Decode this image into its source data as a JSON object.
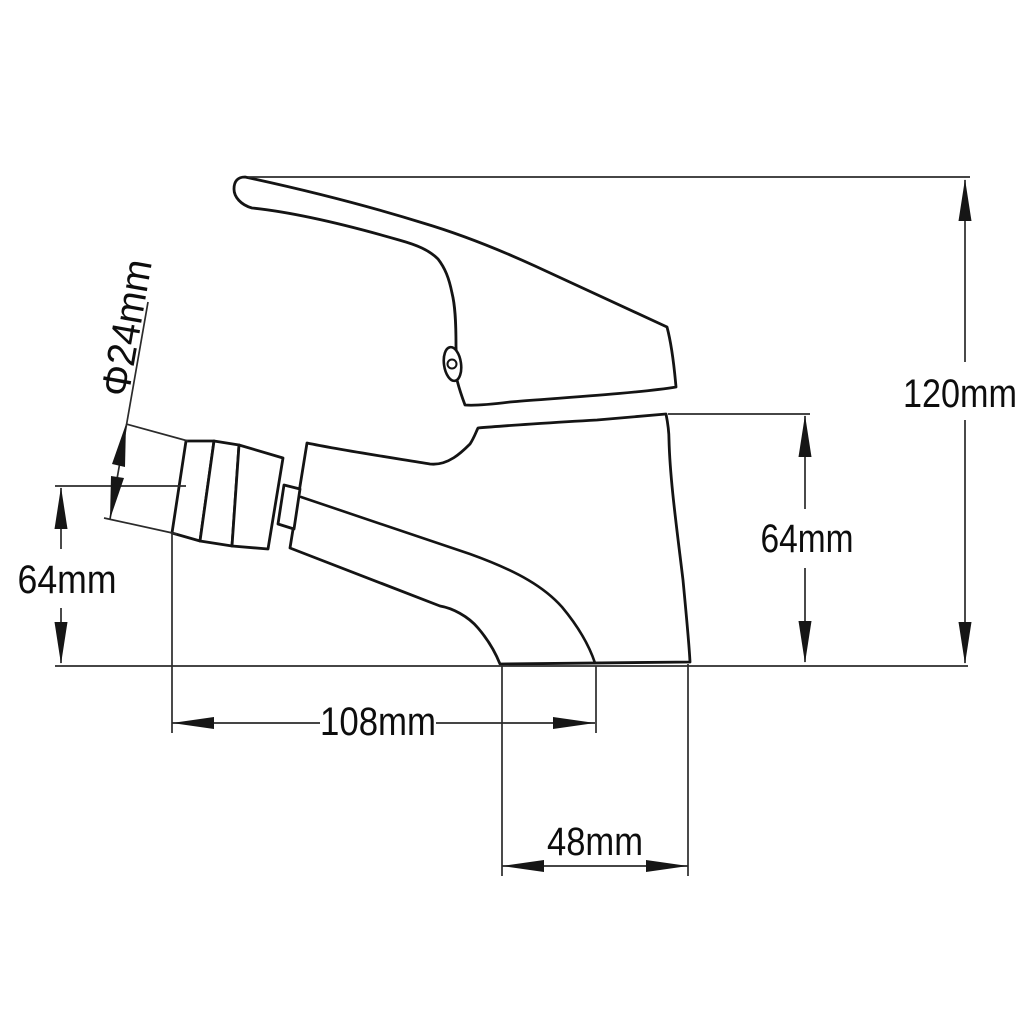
{
  "drawing": {
    "title": "Basin mixer faucet technical drawing, side view",
    "type": "dimensioned line drawing",
    "background_color": "#ffffff",
    "outline_color": "#141414",
    "dimension_line_color": "#2b2b2b",
    "text_color": "#0d0d0d",
    "dimensions": [
      {
        "name": "total_height",
        "label": "120mm",
        "value": 120,
        "unit": "mm",
        "orientation": "vertical"
      },
      {
        "name": "body_height",
        "label": "64mm",
        "value": 64,
        "unit": "mm",
        "orientation": "vertical"
      },
      {
        "name": "outlet_height",
        "label": "64mm",
        "value": 64,
        "unit": "mm",
        "orientation": "vertical"
      },
      {
        "name": "spout_reach",
        "label": "108mm",
        "value": 108,
        "unit": "mm",
        "orientation": "horizontal"
      },
      {
        "name": "base_depth",
        "label": "48mm",
        "value": 48,
        "unit": "mm",
        "orientation": "horizontal"
      },
      {
        "name": "aerator_diameter",
        "label": "Φ24mm",
        "value": 24,
        "unit": "mm",
        "prefix": "Φ",
        "orientation": "diagonal"
      }
    ]
  }
}
